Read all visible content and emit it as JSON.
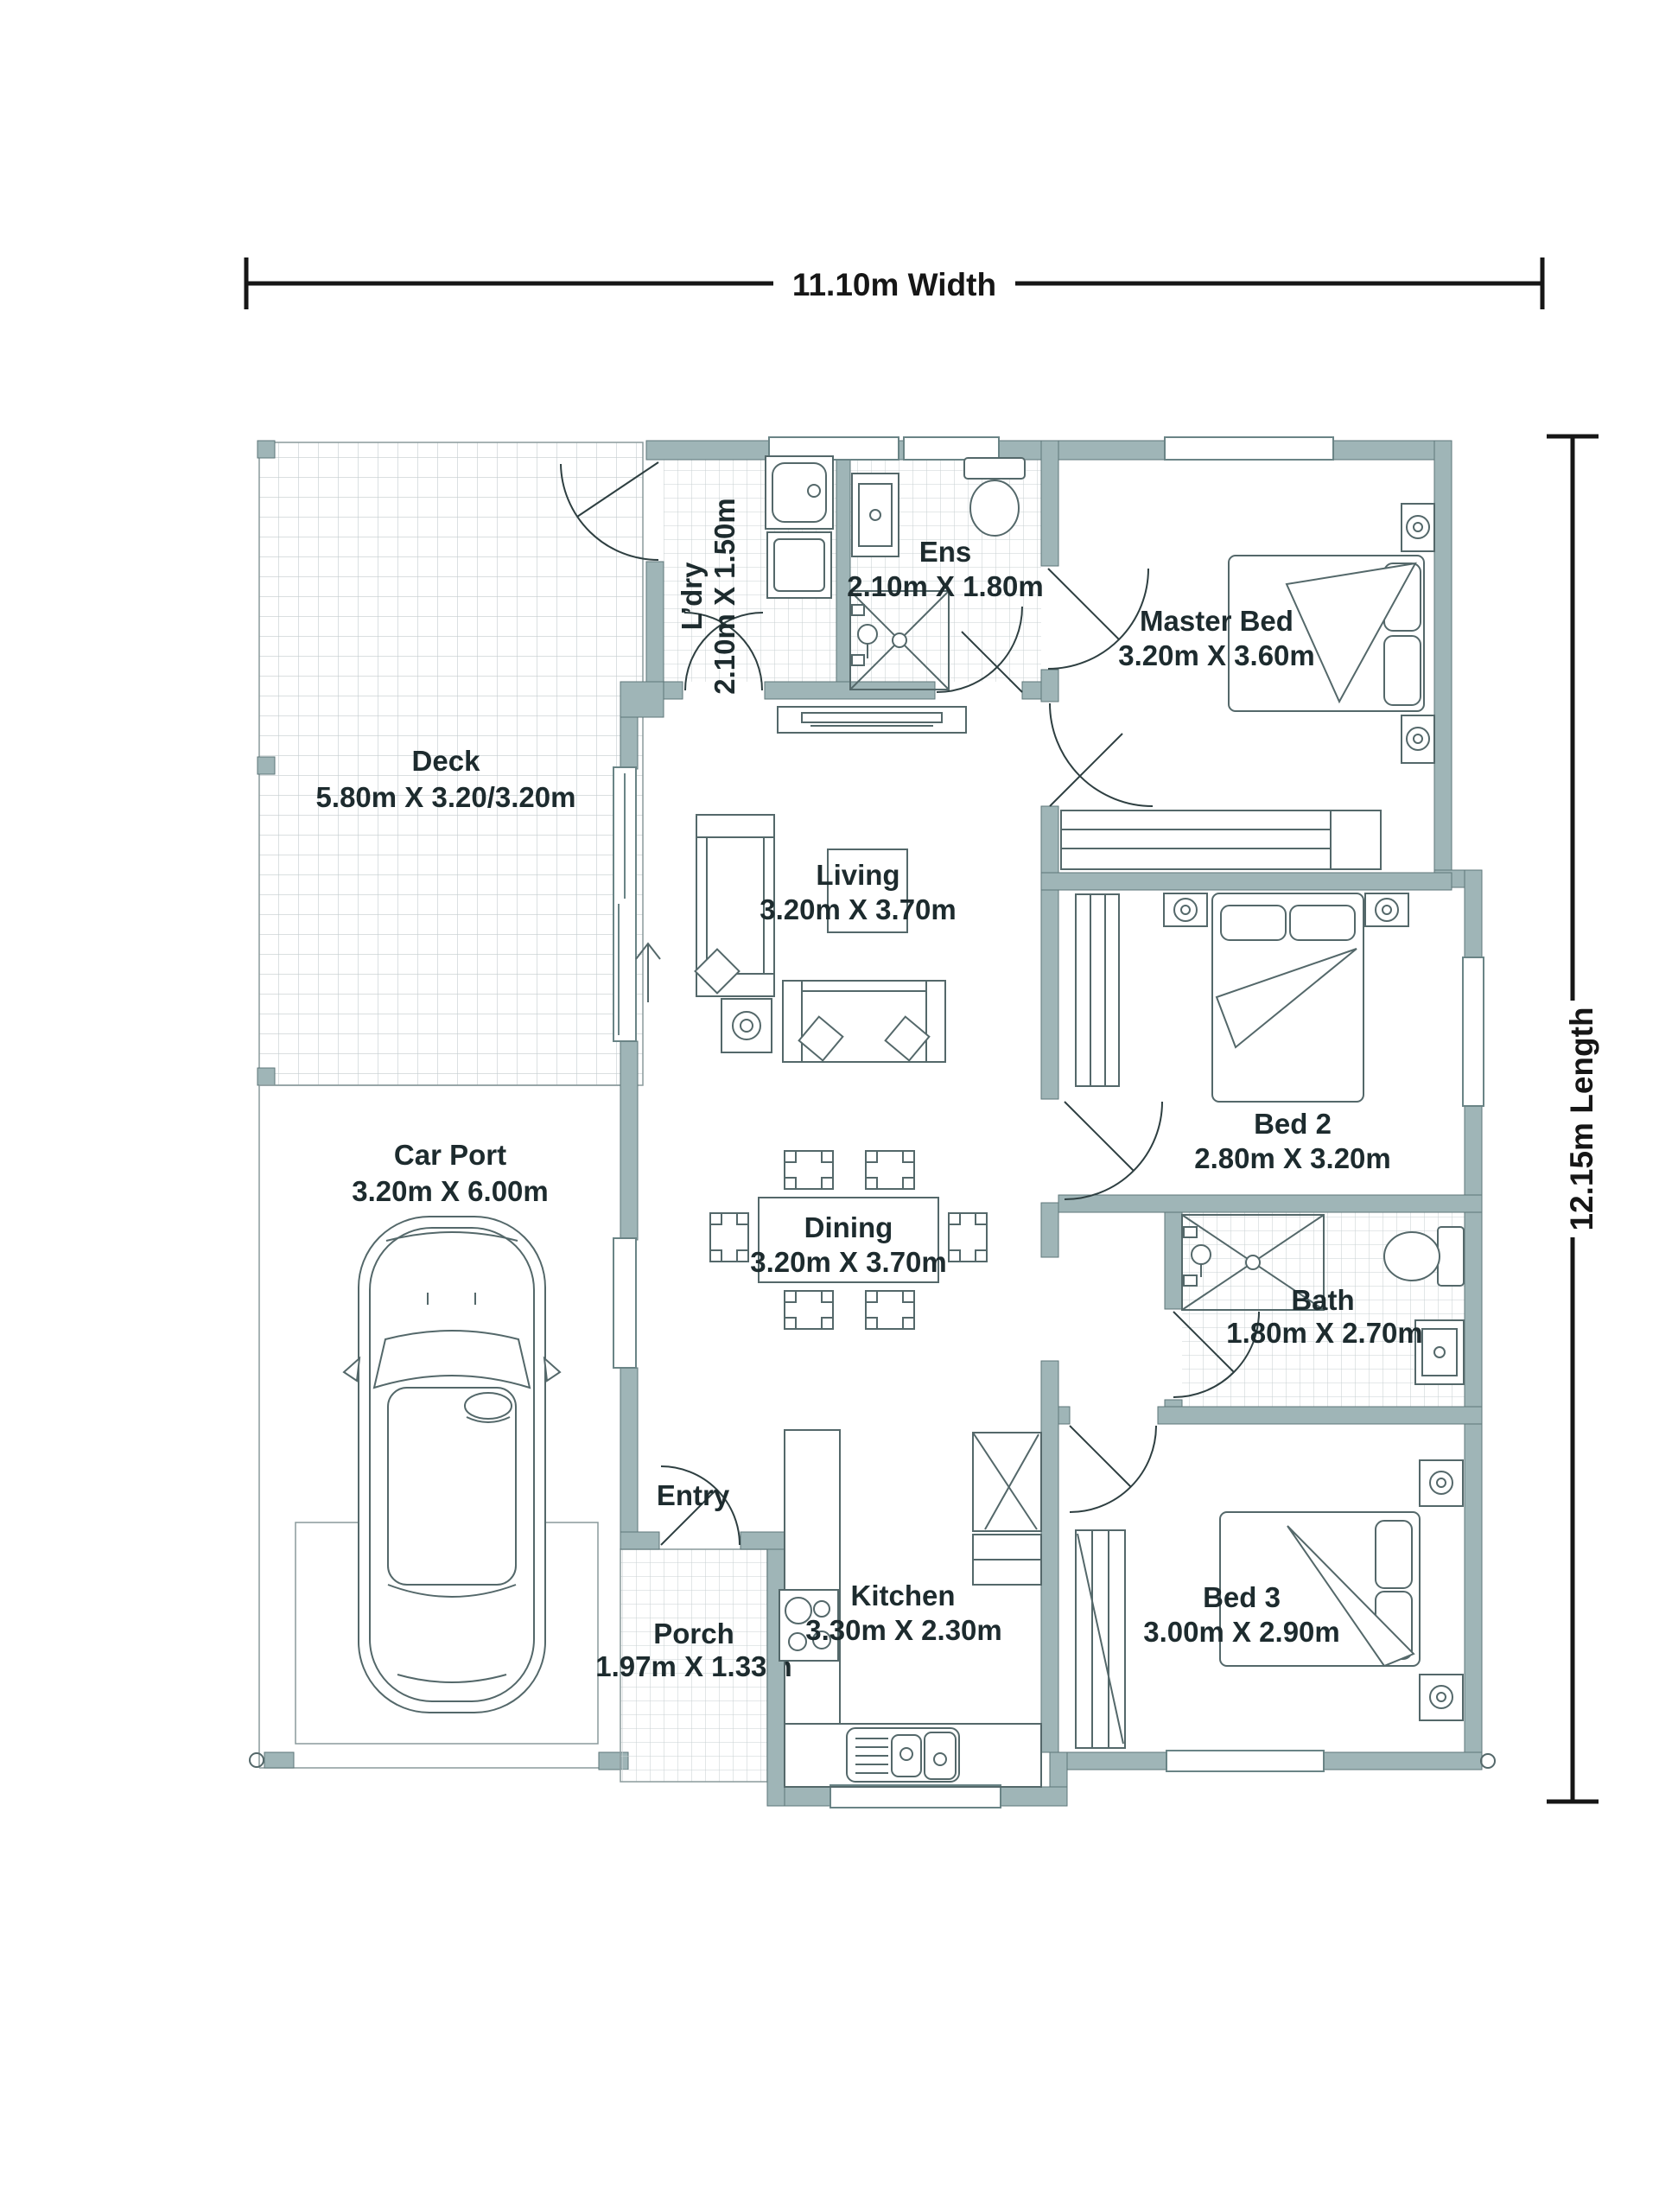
{
  "dimensions": {
    "width": "11.10m Width",
    "length": "12.15m Length"
  },
  "rooms": {
    "deck": {
      "name": "Deck",
      "dims": "5.80m X 3.20/3.20m"
    },
    "ldry": {
      "name": "L’dry",
      "dims": "2.10m X 1.50m"
    },
    "ens": {
      "name": "Ens",
      "dims": "2.10m X 1.80m"
    },
    "master_bed": {
      "name": "Master Bed",
      "dims": "3.20m X 3.60m"
    },
    "living": {
      "name": "Living",
      "dims": "3.20m X 3.70m"
    },
    "car_port": {
      "name": "Car Port",
      "dims": "3.20m X 6.00m"
    },
    "dining": {
      "name": "Dining",
      "dims": "3.20m X 3.70m"
    },
    "bath": {
      "name": "Bath",
      "dims": "1.80m X 2.70m"
    },
    "entry": {
      "name": "Entry"
    },
    "porch": {
      "name": "Porch",
      "dims": "1.97m X 1.33m"
    },
    "kitchen": {
      "name": "Kitchen",
      "dims": "3.30m X 2.30m"
    },
    "bed2": {
      "name": "Bed 2",
      "dims": "2.80m X 3.20m"
    },
    "bed3": {
      "name": "Bed 3",
      "dims": "3.00m X 2.90m"
    }
  },
  "colors": {
    "wall": "#9FB5B7",
    "line": "#54686a",
    "tile": "#c7d0d2",
    "text": "#1d2b2e"
  }
}
